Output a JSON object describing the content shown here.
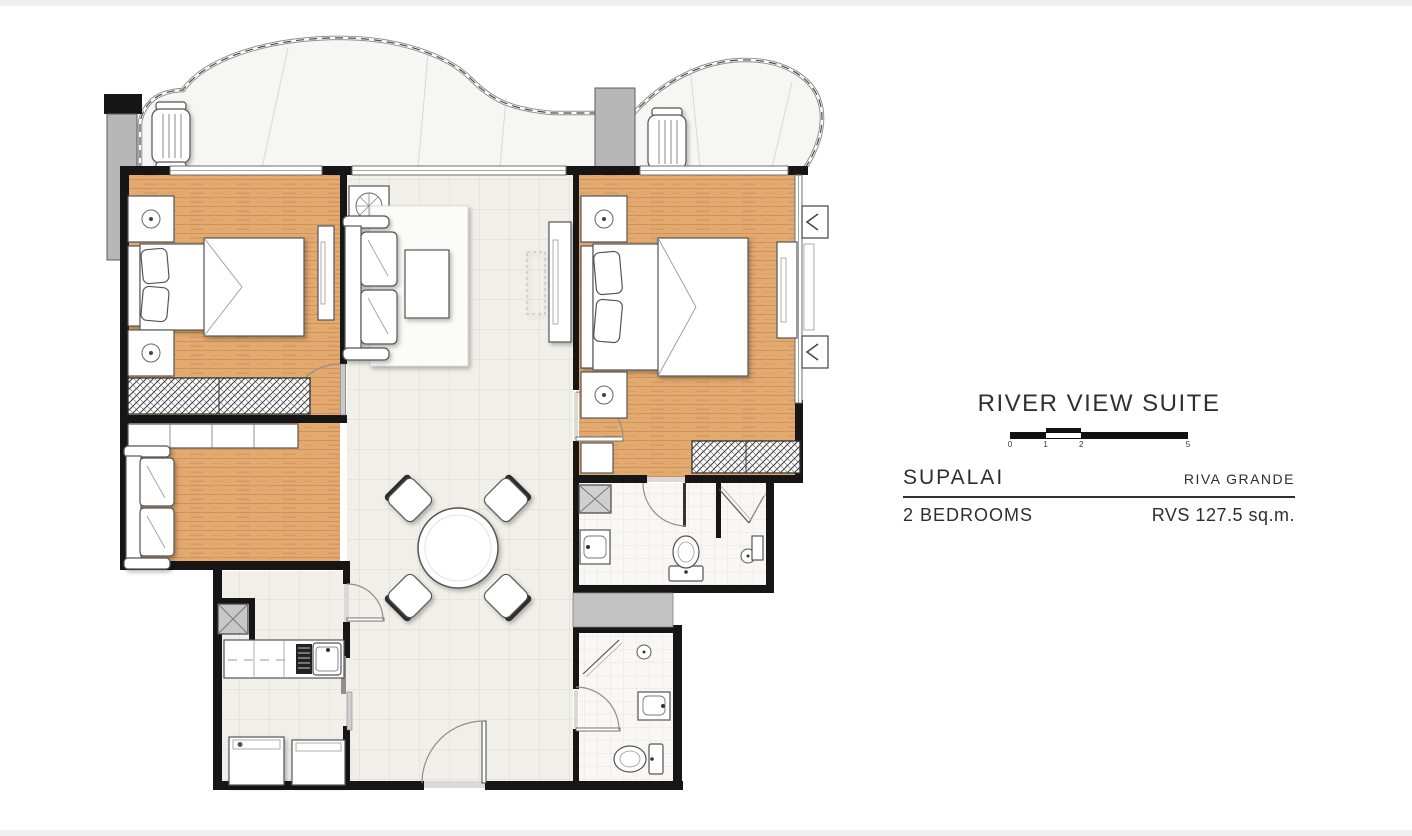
{
  "page": {
    "background": "#ffffff",
    "edge_strip_color": "#efefef"
  },
  "title_block": {
    "title": "RIVER VIEW SUITE",
    "brand": "SUPALAI",
    "project": "RIVA GRANDE",
    "unit_type": "2 BEDROOMS",
    "area": "RVS 127.5 sq.m.",
    "scale_ticks": [
      "0",
      "1",
      "2",
      "5"
    ]
  },
  "floor_plan": {
    "colors": {
      "wall": "#161616",
      "wood_floor": "#e3a96f",
      "tile_floor": "#f0efe9",
      "bath_tile": "#f8f7f3",
      "balcony": "#f6f6f4",
      "column_gray": "#b7b7b7",
      "ledge_gray": "#c3c3c3",
      "furniture_outline": "#555555"
    },
    "rooms": [
      "balcony",
      "bedroom-2",
      "sitting-area",
      "living-room",
      "dining-area",
      "kitchen",
      "master-bedroom",
      "master-bathroom",
      "guest-bathroom"
    ]
  }
}
